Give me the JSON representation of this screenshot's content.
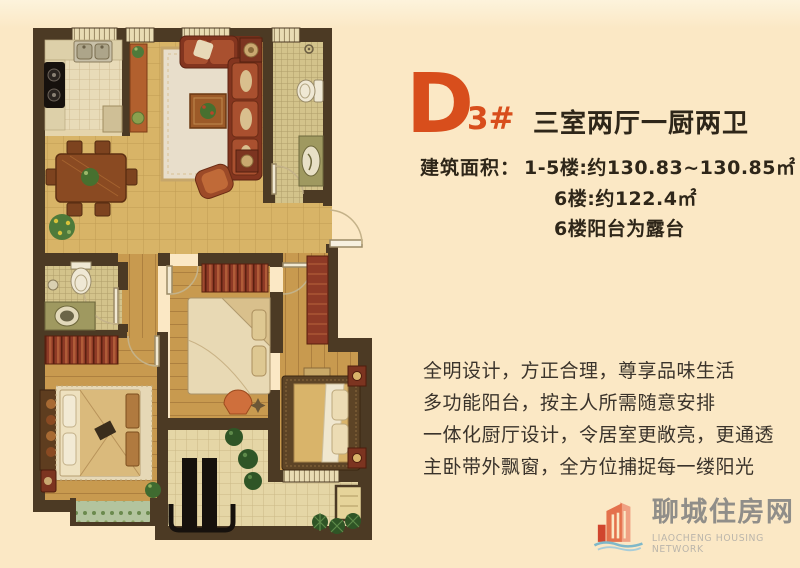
{
  "unit": {
    "letter": "D",
    "number": "3#",
    "layout_title": "三室两厅一厨两卫",
    "area_label": "建筑面积：",
    "area_lines": [
      "1-5楼:约130.83~130.85㎡",
      "6楼:约122.4㎡",
      "6楼阳台为露台"
    ]
  },
  "features": [
    "全明设计，方正合理，尊享品味生活",
    "多功能阳台，按主人所需随意安排",
    "一体化厨厅设计，令居室更敞亮，更通透",
    "主卧带外飘窗，全方位捕捉每一缕阳光"
  ],
  "logo": {
    "name": "聊城住房网",
    "tagline": "LIAOCHENG HOUSING NETWORK"
  },
  "floor_plan": {
    "legend": [
      "kitchen",
      "dining-area",
      "living-room",
      "bathroom",
      "second-bathroom",
      "study-bedroom",
      "second-bedroom",
      "master-bedroom",
      "multi-function-balcony",
      "south-balcony",
      "entry",
      "bay-window"
    ]
  },
  "palette": {
    "bg": "#fbe8c5",
    "bgTop": "#fdf3dc",
    "accent": "#d84e1c",
    "titleColor": "#2e2619",
    "textColor": "#3a332b",
    "wall": "#4c3a24",
    "tan": "#d8b467",
    "kitchenTile": "#e8dbb8",
    "mosaic": "#d3c38b",
    "wood": "#c89a4f",
    "balconyTile": "#e5d6a6",
    "rug": "#e8decb",
    "sofa": "#83351f",
    "sofaCushion": "#a9502f",
    "redFurn": "#8e3a26",
    "oliveCounter": "#9f9960",
    "fixture": "#efe8d4",
    "black": "#16110d",
    "plant": "#2f5526",
    "plantLight": "#5e8a4a",
    "bayGreen": "#b3c49e",
    "winFill": "#e9dcb4",
    "bedTan": "#d9b46a",
    "blanket": "#daba7c",
    "logoGray": "#908e89",
    "logoLightGray": "#bab5ab",
    "logoOrange": "#e4714c",
    "logoOrangeLight": "#f0a183",
    "logoRed": "#d0452e",
    "logoBlue": "#7fb8c9"
  }
}
